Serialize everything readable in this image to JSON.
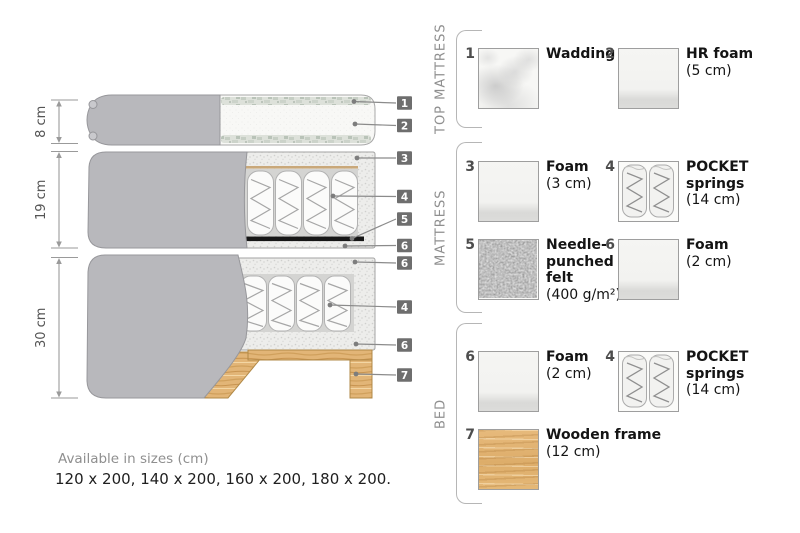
{
  "diagram": {
    "measurements": [
      {
        "label": "8 cm"
      },
      {
        "label": "19 cm"
      },
      {
        "label": "30 cm"
      }
    ],
    "callouts": [
      {
        "number": "1"
      },
      {
        "number": "2"
      },
      {
        "number": "3"
      },
      {
        "number": "4"
      },
      {
        "number": "5"
      },
      {
        "number": "6"
      },
      {
        "number": "6"
      },
      {
        "number": "4"
      },
      {
        "number": "6"
      },
      {
        "number": "7"
      }
    ],
    "sizes_heading": "Available in sizes (cm)",
    "sizes_line": "120 x 200, 140 x 200, 160 x 200, 180 x 200."
  },
  "legend": {
    "sections": [
      {
        "label": "TOP MATTRESS",
        "items": [
          {
            "number": "1",
            "swatch": "wadding",
            "name_lines": [
              "Wadding"
            ],
            "size": ""
          },
          {
            "number": "2",
            "swatch": "foam",
            "name_lines": [
              "HR foam"
            ],
            "size": "(5 cm)"
          }
        ]
      },
      {
        "label": "MATTRESS",
        "items": [
          {
            "number": "3",
            "swatch": "foam",
            "name_lines": [
              "Foam"
            ],
            "size": "(3 cm)"
          },
          {
            "number": "4",
            "swatch": "springs",
            "name_lines": [
              "POCKET",
              "springs"
            ],
            "size": "(14 cm)"
          },
          {
            "number": "5",
            "swatch": "felt",
            "name_lines": [
              "Needle-",
              "punched",
              "felt"
            ],
            "size": "(400 g/m²)"
          },
          {
            "number": "6",
            "swatch": "foam",
            "name_lines": [
              "Foam"
            ],
            "size": "(2 cm)"
          }
        ]
      },
      {
        "label": "BED",
        "items": [
          {
            "number": "6",
            "swatch": "foam",
            "name_lines": [
              "Foam"
            ],
            "size": "(2 cm)"
          },
          {
            "number": "4",
            "swatch": "springs",
            "name_lines": [
              "POCKET",
              "springs"
            ],
            "size": "(14 cm)"
          },
          {
            "number": "7",
            "swatch": "wood",
            "name_lines": [
              "Wooden frame"
            ],
            "size": "(12 cm)"
          }
        ]
      }
    ]
  },
  "colors": {
    "fabric_gray": "#b8b8bc",
    "fabric_border": "#97979b",
    "tag_gray": "#6e6e6e",
    "wood_tan": "#e2b577",
    "felt_gray": "#6e6e6e",
    "text_dark": "#141414",
    "text_muted": "#8f8f8f",
    "leader_line": "#8b8b8b"
  }
}
